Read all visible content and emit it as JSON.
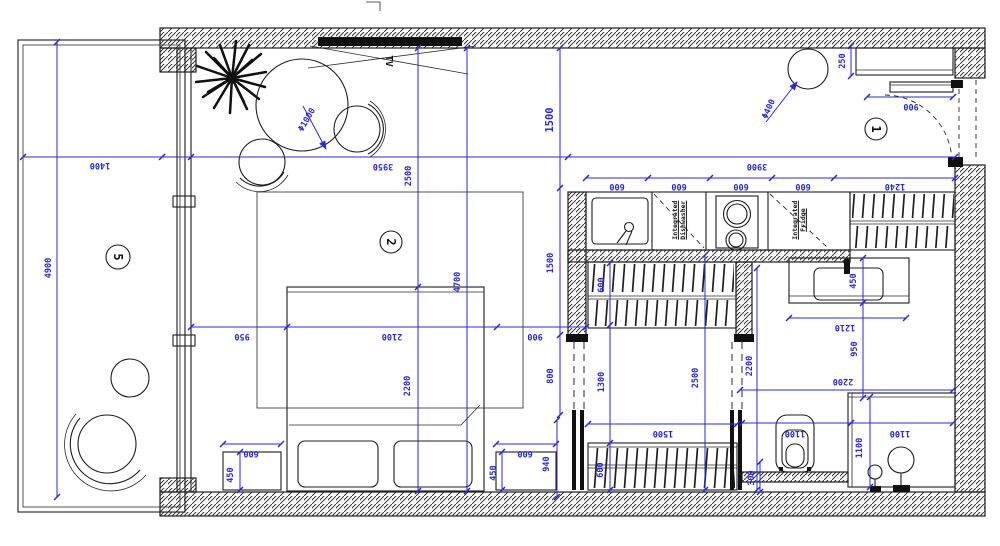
{
  "room_labels": {
    "entry": "1",
    "living": "2",
    "balcony": "5"
  },
  "labels": {
    "tv": "TV",
    "dishwasher": "Integrated Dishwasher",
    "fridge": "Integrated Fridge"
  },
  "dims": {
    "balcony_width": "1400",
    "balcony_length": "4900",
    "living_width": "3950",
    "right_zone_width": "3900",
    "entry_depth": "1500",
    "living_depth_a": "2500",
    "room_depth_total": "4700",
    "mid_depth": "1500",
    "bed_side_left": "950",
    "bed_width": "2100",
    "bed_side_right": "900",
    "bed_length": "2200",
    "passage": "800",
    "closet_depth": "600",
    "closet_passage": "1300",
    "dressing_depth": "2500",
    "bath_depth": "2200",
    "kitchen_units": [
      "600",
      "600",
      "600",
      "600",
      "1240"
    ],
    "entry_cabinet_depth": "250",
    "entry_shelf_width": "900",
    "light_diameter": "Φ400",
    "table_diameter": "Φ1000",
    "vanity_depth": "450",
    "vanity_width": "1210",
    "vanity_clearance": "950",
    "bath_width": "2200",
    "toilet_zone_width": "1100",
    "shower_width": "1100",
    "shower_depth": "1100",
    "rear_gap": "300",
    "wardrobe_width": "1500",
    "wardrobe_depth": "600",
    "nightstand_left_width": "600",
    "nightstand_left_depth": "450",
    "nightstand_right_width": "600",
    "nightstand_right_depth": "450",
    "nightstand_right_offset": "940"
  },
  "colors": {
    "dimension_blue": "#2828dc",
    "line_black": "#1d1d1d"
  }
}
